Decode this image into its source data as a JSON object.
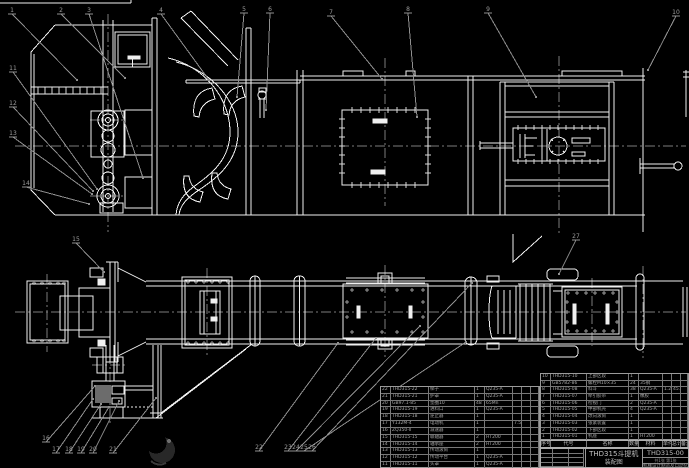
{
  "drawing_meta": {
    "title_line1": "THD315斗提机",
    "title_line2": "装配图",
    "drawing_number": "THD315-00",
    "sheet_info": "共1张 第1张",
    "org": "机械设计制造及自动化",
    "colors": {
      "background": "#000000",
      "line": "#f0f0f0",
      "centerline": "#7d7d7d",
      "label": "#9a9a9a"
    }
  },
  "parts_list": {
    "header": [
      "序号",
      "代号",
      "名称",
      "数量",
      "材料",
      "单件",
      "总计",
      "备注"
    ],
    "right_rows": [
      [
        "10",
        "THD315-10",
        "上部区段",
        "1",
        "",
        "",
        "",
        ""
      ],
      [
        "9",
        "GB5782-86",
        "螺栓M10×35",
        "24",
        "35钢",
        "",
        "",
        ""
      ],
      [
        "8",
        "THD315-08",
        "料斗",
        "38",
        "Q235-A",
        "1.2",
        "45.6",
        ""
      ],
      [
        "7",
        "THD315-07",
        "牵引胶带",
        "1",
        "橡胶",
        "",
        "",
        ""
      ],
      [
        "6",
        "THD315-06",
        "检视门",
        "2",
        "Q235-A",
        "",
        "",
        ""
      ],
      [
        "5",
        "THD315-05",
        "中部机壳",
        "4",
        "Q235-A",
        "",
        "",
        ""
      ],
      [
        "4",
        "THD315-04",
        "改向滚筒",
        "1",
        "",
        "",
        "",
        ""
      ],
      [
        "3",
        "THD315-03",
        "张紧装置",
        "1",
        "",
        "",
        "",
        ""
      ],
      [
        "2",
        "THD315-02",
        "下部区段",
        "1",
        "",
        "",
        "",
        ""
      ],
      [
        "1",
        "THD315-01",
        "机座",
        "1",
        "HT200",
        "",
        "",
        ""
      ]
    ],
    "left_rows": [
      [
        "22",
        "THD315-22",
        "梯子",
        "1",
        "Q235-A",
        "",
        "",
        ""
      ],
      [
        "21",
        "THD315-21",
        "护罩",
        "1",
        "Q235-A",
        "",
        "",
        ""
      ],
      [
        "20",
        "GB97.1-85",
        "垫圈10",
        "48",
        "65Mn",
        "",
        "",
        ""
      ],
      [
        "19",
        "THD315-19",
        "进料口",
        "1",
        "Q235-A",
        "",
        "",
        ""
      ],
      [
        "18",
        "THD315-18",
        "逆止器",
        "1",
        "",
        "",
        "",
        ""
      ],
      [
        "17",
        "Y132M-4",
        "电动机",
        "1",
        "",
        "7.5kW",
        "",
        ""
      ],
      [
        "16",
        "ZQ350-Ⅱ",
        "减速器",
        "1",
        "",
        "",
        "",
        ""
      ],
      [
        "15",
        "THD315-15",
        "联轴器",
        "2",
        "HT200",
        "",
        "",
        ""
      ],
      [
        "14",
        "THD315-14",
        "轴承座",
        "2",
        "HT200",
        "",
        "",
        ""
      ],
      [
        "13",
        "THD315-13",
        "传动滚筒",
        "1",
        "",
        "",
        "",
        ""
      ],
      [
        "12",
        "THD315-12",
        "传动平台",
        "1",
        "Q235-A",
        "",
        "",
        ""
      ],
      [
        "11",
        "THD315-11",
        "头罩",
        "1",
        "Q235-A",
        "",
        "",
        ""
      ]
    ]
  },
  "callouts": [
    {
      "n": "1",
      "x": 11,
      "y": 10,
      "tx": 77,
      "ty": 80
    },
    {
      "n": "2",
      "x": 60,
      "y": 10,
      "tx": 125,
      "ty": 78
    },
    {
      "n": "3",
      "x": 88,
      "y": 10,
      "tx": 143,
      "ty": 178
    },
    {
      "n": "4",
      "x": 160,
      "y": 10,
      "tx": 209,
      "ty": 80
    },
    {
      "n": "5",
      "x": 243,
      "y": 9,
      "tx": 237,
      "ty": 97
    },
    {
      "n": "6",
      "x": 269,
      "y": 9,
      "tx": 266,
      "ty": 110
    },
    {
      "n": "7",
      "x": 330,
      "y": 12,
      "tx": 382,
      "ty": 79
    },
    {
      "n": "8",
      "x": 407,
      "y": 9,
      "tx": 417,
      "ty": 117
    },
    {
      "n": "9",
      "x": 487,
      "y": 9,
      "tx": 536,
      "ty": 97
    },
    {
      "n": "10",
      "x": 675,
      "y": 12,
      "tx": 648,
      "ty": 70
    },
    {
      "n": "11",
      "x": 12,
      "y": 68,
      "tx": 97,
      "ty": 189
    },
    {
      "n": "12",
      "x": 12,
      "y": 103,
      "tx": 93,
      "ty": 191
    },
    {
      "n": "13",
      "x": 12,
      "y": 133,
      "tx": 92,
      "ty": 194
    },
    {
      "n": "14",
      "x": 25,
      "y": 183,
      "tx": 89,
      "ty": 204
    },
    {
      "n": "15",
      "x": 75,
      "y": 239,
      "tx": 104,
      "ty": 272
    },
    {
      "n": "16",
      "x": 45,
      "y": 438,
      "tx": 95,
      "ty": 386
    },
    {
      "n": "17",
      "x": 55,
      "y": 449,
      "tx": 93,
      "ty": 399
    },
    {
      "n": "18",
      "x": 68,
      "y": 449,
      "tx": 101,
      "ty": 404
    },
    {
      "n": "19",
      "x": 80,
      "y": 449,
      "tx": 109,
      "ty": 407
    },
    {
      "n": "20",
      "x": 92,
      "y": 449,
      "tx": 119,
      "ty": 401
    },
    {
      "n": "21",
      "x": 112,
      "y": 449,
      "tx": 156,
      "ty": 398
    },
    {
      "n": "22",
      "x": 258,
      "y": 447,
      "tx": 338,
      "ty": 343
    },
    {
      "n": "23",
      "x": 287,
      "y": 447,
      "tx": 376,
      "ty": 338
    },
    {
      "n": "24",
      "x": 295,
      "y": 447,
      "tx": 420,
      "ty": 326
    },
    {
      "n": "25",
      "x": 303,
      "y": 447,
      "tx": 466,
      "ty": 342
    },
    {
      "n": "26",
      "x": 311,
      "y": 447,
      "tx": 472,
      "ty": 283
    },
    {
      "n": "27",
      "x": 575,
      "y": 236,
      "tx": 559,
      "ty": 274
    }
  ]
}
